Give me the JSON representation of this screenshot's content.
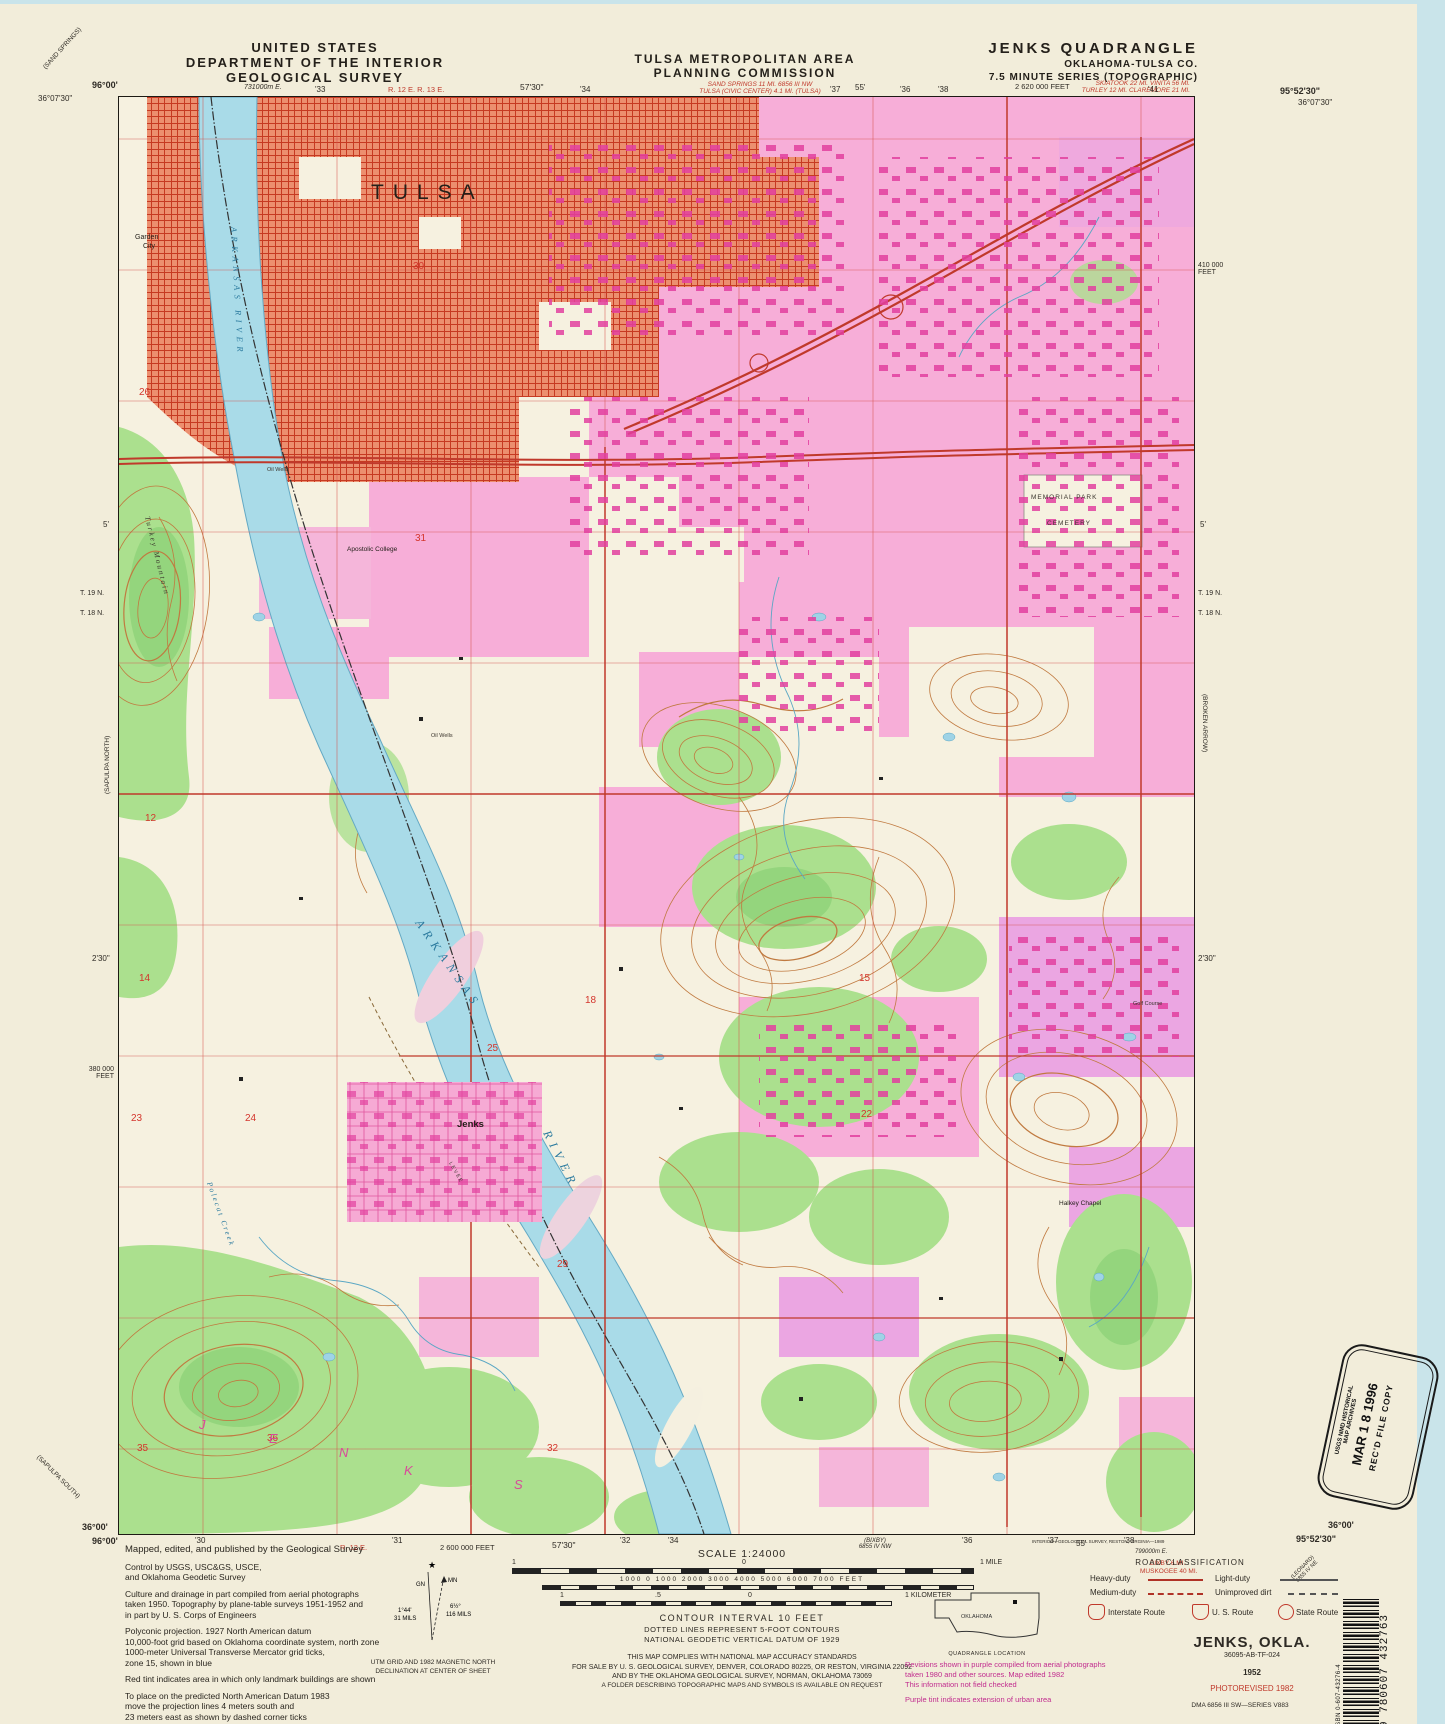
{
  "header": {
    "us1": "UNITED STATES",
    "us2": "DEPARTMENT OF THE INTERIOR",
    "us3": "GEOLOGICAL SURVEY",
    "tmapc1": "TULSA METROPOLITAN AREA",
    "tmapc2": "PLANNING COMMISSION",
    "quad1": "JENKS QUADRANGLE",
    "quad2": "OKLAHOMA-TULSA CO.",
    "quad3": "7.5 MINUTE SERIES (TOPOGRAPHIC)",
    "red_center1": "SAND SPRINGS 11 MI.      6856 III NW",
    "red_center2": "TULSA (CIVIC CENTER) 4.1 MI.      (TULSA)",
    "red_right1": "SKIATOOK 22 MI.    VINITA 56 MI.",
    "red_right2": "TURLEY 12 MI.    CLAREMORE 21 MI."
  },
  "ticks": {
    "tl_lon": "96°00'",
    "tl_lat": "36°07'30\"",
    "utm_e": "731000m E.",
    "t33": "'33",
    "r1213": "R. 12 E.  R. 13 E.",
    "t5730": "57'30\"",
    "t34": "'34",
    "t36": "'36",
    "t37": "'37",
    "t55": "55'",
    "t38": "'38",
    "feet2620": "2 620 000 FEET",
    "t41": "'41",
    "tr_lon": "95°52'30\"",
    "tr_lat": "36°07'30\"",
    "sand_springs": "(SAND SPRINGS)",
    "sapulpa_n": "(SAPULPA NORTH)",
    "sapulpa_s": "(SAPULPA SOUTH)",
    "feet380a": "380 000",
    "feet380b": "FEET",
    "feet410a": "410 000",
    "feet410b": "FEET",
    "t19n": "T. 19 N.",
    "t18n": "T. 18 N.",
    "five": "5'",
    "two30": "2'30\"",
    "broken_arrow": "(BROKEN ARROW)",
    "bl_lat": "36°00'",
    "bl_lon": "96°00'",
    "br_lat": "36°00'",
    "br_lon": "95°52'30\"",
    "b30": "'30",
    "br12": "R. 12 E.",
    "b31": "'31",
    "feet2600": "2 600 000 FEET",
    "b5730": "57'30\"",
    "b32": "'32",
    "b34": "'34",
    "bixby1": "(BIXBY)",
    "bixby2": "6855 IV NW",
    "b36": "'36",
    "b37": "'37",
    "b55": "55'",
    "b38": "'38",
    "interior": "INTERIOR—GEOLOGICAL SURVEY, RESTON, VIRGINIA—1989",
    "utm799": "799000m E.",
    "red_bixby": "BIXBY 6 MI.",
    "red_muskogee": "MUSKOGEE 40 MI.",
    "leonard1": "(LEONARD)",
    "leonard2": "6855 IV NE"
  },
  "map": {
    "labels": {
      "tulsa": "TULSA",
      "garden1": "Garden",
      "garden2": "City",
      "ark_upper": "ARKANSAS RIVER",
      "arkansas": "ARKANSAS",
      "river": "RIVER",
      "turkey": "Turkey Mountain",
      "apostolic": "Apostolic College",
      "memorial1": "MEMORIAL PARK",
      "memorial2": "CEMETERY",
      "jenks": "Jenks",
      "polecat": "Polecat Creek",
      "halkey": "Halkey Chapel",
      "golf": "Golf Course",
      "oil1": "Oil Wells",
      "oil2": "Oil Wells",
      "levee": "LEVEE"
    },
    "jenks_letters": [
      "J",
      "E",
      "N",
      "K",
      "S"
    ],
    "sections": {
      "s26": "26",
      "s30": "30",
      "s31": "31",
      "s12": "12",
      "s14": "14",
      "s23": "23",
      "s24": "24",
      "s15": "15",
      "s22": "22",
      "s18": "18",
      "s25": "25",
      "s29": "29",
      "s36": "36",
      "s35": "35",
      "s32": "32"
    }
  },
  "footer": {
    "credits_p1": [
      "Mapped, edited, and published by the Geological Survey"
    ],
    "credits_p2": [
      "Control by USGS, USC&GS, USCE,",
      "and Oklahoma Geodetic Survey"
    ],
    "credits_p3": [
      "Culture and drainage in part compiled from aerial photographs",
      "taken 1950.   Topography by plane-table surveys 1951-1952 and",
      "in part by U. S. Corps of Engineers"
    ],
    "credits_p4": [
      "Polyconic projection.   1927 North American datum",
      "10,000-foot grid based on Oklahoma coordinate system, north zone",
      "1000-meter Universal Transverse Mercator grid ticks,",
      "zone 15, shown in blue"
    ],
    "credits_p5": [
      "Red tint indicates area in which only landmark buildings are shown"
    ],
    "credits_p6": [
      "To place on the predicted North American Datum 1983",
      "move the projection lines 4 meters south and",
      "23 meters east as shown by dashed corner ticks"
    ],
    "decl": {
      "gn": "GN",
      "mn": "MN",
      "a1": "1°44'",
      "a2": "31 MILS",
      "b1": "6½°",
      "b2": "116 MILS",
      "cap1": "UTM GRID AND 1982 MAGNETIC NORTH",
      "cap2": "DECLINATION AT CENTER OF SHEET"
    },
    "scale_title": "SCALE 1:24000",
    "scale_mile_left": "1",
    "scale_mile_zero": "0",
    "scale_mile_right": "1 MILE",
    "scale_feet": "1000    0    1000    2000    3000    4000    5000    6000    7000 FEET",
    "scale_km_left": "1",
    "scale_km_half": ".5",
    "scale_km_zero": "0",
    "scale_km_right": "1 KILOMETER",
    "contour1": "CONTOUR INTERVAL 10 FEET",
    "contour2": "DOTTED LINES REPRESENT 5-FOOT CONTOURS",
    "contour3": "NATIONAL GEODETIC VERTICAL DATUM OF 1929",
    "sale1": "THIS MAP COMPLIES WITH NATIONAL MAP ACCURACY STANDARDS",
    "sale2": "FOR SALE BY U. S. GEOLOGICAL SURVEY, DENVER, COLORADO 80225, OR RESTON, VIRGINIA 22092",
    "sale3": "AND BY THE OKLAHOMA GEOLOGICAL SURVEY, NORMAN, OKLAHOMA 73069",
    "sale4": "A FOLDER DESCRIBING TOPOGRAPHIC MAPS AND SYMBOLS IS AVAILABLE ON REQUEST",
    "state_label": "OKLAHOMA",
    "quadloc": "QUADRANGLE LOCATION",
    "purple1": "Revisions shown in purple compiled from aerial photographs",
    "purple2": "taken 1980 and other sources.   Map edited 1982",
    "purple3": "This information not field checked",
    "purple4": "Purple tint indicates extension of urban area",
    "roadclass": {
      "title": "ROAD CLASSIFICATION",
      "heavy": "Heavy-duty",
      "medium": "Medium-duty",
      "light": "Light-duty",
      "unimproved": "Unimproved dirt",
      "interstate": "Interstate Route",
      "us": "U. S. Route",
      "state": "State Route"
    },
    "map_name": "JENKS, OKLA.",
    "map_code": "36095-AB-TF-024",
    "year": "1952",
    "photorev": "PHOTOREVISED 1982",
    "dma": "DMA 6856 III SW—SERIES V883"
  },
  "stamp": {
    "l1": "USGS NMD HISTORICAL",
    "l2": "MAP ARCHIVES",
    "l3": "MAR 1 8 1996",
    "l4": "REC'D FILE COPY"
  },
  "barcode": {
    "isbn": "ISBN 0-607-43276-4",
    "digits": "9 780607 432763"
  },
  "colors": {
    "urban_pink": "#f7aed8",
    "building_magenta": "#e2409f",
    "road_red": "#c0392b",
    "veg_green": "#abe08e",
    "water_blue": "#a9dbe8",
    "contour_brown": "#c07a40",
    "red_tint": "#ec8f6f",
    "purple_note": "#c12c8e",
    "paper": "#f2edda"
  }
}
